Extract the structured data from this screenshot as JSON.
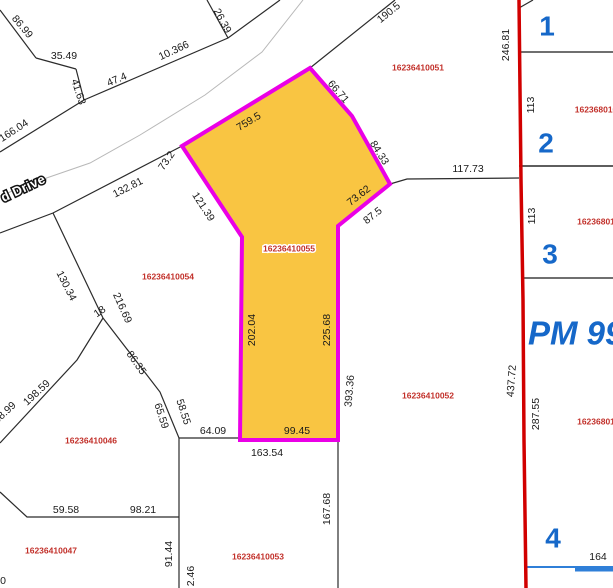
{
  "map": {
    "background": "#ffffff",
    "line_color": "#2b2b2b",
    "selected_parcel": {
      "id": "16236410055",
      "fill": "#f9c542",
      "stroke": "#ea00e6",
      "vertices": [
        [
          182,
          146
        ],
        [
          310,
          68
        ],
        [
          352,
          116
        ],
        [
          390,
          184
        ],
        [
          338,
          226
        ],
        [
          338,
          440
        ],
        [
          240,
          440
        ],
        [
          242,
          237
        ]
      ]
    },
    "pm_boundary": {
      "color": "#d10000",
      "points": [
        [
          519,
          0
        ],
        [
          520,
          90
        ],
        [
          521,
          180
        ],
        [
          523,
          300
        ],
        [
          524,
          440
        ],
        [
          526,
          588
        ]
      ]
    },
    "lines": [
      {
        "name": "lot-line",
        "points": [
          [
            0,
            10
          ],
          [
            36,
            58
          ]
        ]
      },
      {
        "name": "lot-line",
        "points": [
          [
            36,
            58
          ],
          [
            76,
            69
          ]
        ]
      },
      {
        "name": "lot-line",
        "points": [
          [
            76,
            69
          ],
          [
            84,
            100
          ]
        ]
      },
      {
        "name": "road-edge-upper",
        "points": [
          [
            84,
            100
          ],
          [
            228,
            38
          ],
          [
            280,
            0
          ]
        ]
      },
      {
        "name": "lot-line",
        "points": [
          [
            228,
            38
          ],
          [
            207,
            0
          ]
        ]
      },
      {
        "name": "road-edge-upper",
        "points": [
          [
            0,
            152
          ],
          [
            84,
            100
          ]
        ]
      },
      {
        "name": "road-centerline",
        "points": [
          [
            303,
            0
          ],
          [
            262,
            52
          ],
          [
            205,
            95
          ],
          [
            140,
            135
          ],
          [
            90,
            163
          ],
          [
            32,
            183
          ],
          [
            0,
            196
          ]
        ],
        "color": "#b8b8b8",
        "width": 1
      },
      {
        "name": "road-edge-lower",
        "points": [
          [
            395,
            0
          ],
          [
            310,
            68
          ]
        ]
      },
      {
        "name": "road-edge-lower",
        "points": [
          [
            182,
            146
          ],
          [
            53,
            213
          ],
          [
            0,
            233
          ]
        ]
      },
      {
        "name": "lot-line",
        "points": [
          [
            53,
            213
          ],
          [
            103,
            318
          ]
        ]
      },
      {
        "name": "lot-line",
        "points": [
          [
            103,
            318
          ],
          [
            160,
            392
          ],
          [
            179,
            438
          ]
        ]
      },
      {
        "name": "lot-line",
        "points": [
          [
            103,
            318
          ],
          [
            77,
            360
          ],
          [
            0,
            443
          ]
        ]
      },
      {
        "name": "lot-line",
        "points": [
          [
            179,
            438
          ],
          [
            338,
            438
          ]
        ]
      },
      {
        "name": "lot-line",
        "points": [
          [
            179,
            438
          ],
          [
            179,
            588
          ]
        ]
      },
      {
        "name": "lot-line",
        "points": [
          [
            338,
            440
          ],
          [
            338,
            588
          ]
        ]
      },
      {
        "name": "lot-line",
        "points": [
          [
            0,
            492
          ],
          [
            27,
            517
          ],
          [
            179,
            517
          ]
        ]
      },
      {
        "name": "lot-line",
        "points": [
          [
            390,
            184
          ],
          [
            407,
            179
          ],
          [
            519,
            178
          ]
        ]
      },
      {
        "name": "lot-line",
        "points": [
          [
            519,
            8
          ],
          [
            533,
            0
          ]
        ]
      },
      {
        "name": "section-line",
        "points": [
          [
            519,
            52
          ],
          [
            613,
            52
          ]
        ],
        "color": "#6f6f6f",
        "width": 2
      },
      {
        "name": "section-line",
        "points": [
          [
            519,
            166
          ],
          [
            613,
            166
          ]
        ],
        "color": "#5e5e5e",
        "width": 2
      },
      {
        "name": "section-line",
        "points": [
          [
            521,
            278
          ],
          [
            613,
            278
          ]
        ],
        "color": "#6f6f6f",
        "width": 2
      },
      {
        "name": "lot-line",
        "points": [
          [
            523,
            350
          ],
          [
            523,
            378
          ]
        ],
        "color": "#111111",
        "width": 1.5
      },
      {
        "name": "blue-line",
        "points": [
          [
            526,
            567
          ],
          [
            613,
            567
          ]
        ],
        "color": "#2f7fd8",
        "width": 2
      },
      {
        "name": "blue-line",
        "points": [
          [
            575,
            569
          ],
          [
            613,
            569
          ]
        ],
        "color": "#2f7fd8",
        "width": 5
      }
    ],
    "dimension_labels": [
      {
        "t": "86.99",
        "x": 22,
        "y": 27,
        "r": 50
      },
      {
        "t": "35.49",
        "x": 64,
        "y": 56,
        "r": 0
      },
      {
        "t": "41.63",
        "x": 78,
        "y": 92,
        "r": 72
      },
      {
        "t": "47.4",
        "x": 117,
        "y": 80,
        "r": -23
      },
      {
        "t": "10.366",
        "x": 174,
        "y": 51,
        "r": -25
      },
      {
        "t": "26.39",
        "x": 222,
        "y": 21,
        "r": 62
      },
      {
        "t": "190.5",
        "x": 389,
        "y": 13,
        "r": -39
      },
      {
        "t": "166.04",
        "x": 14,
        "y": 131,
        "r": -33
      },
      {
        "t": "132.81",
        "x": 128,
        "y": 188,
        "r": -27
      },
      {
        "t": "73.2",
        "x": 167,
        "y": 161,
        "r": -55
      },
      {
        "t": "759.5",
        "x": 249,
        "y": 122,
        "r": -31
      },
      {
        "t": "66.71",
        "x": 338,
        "y": 92,
        "r": 49
      },
      {
        "t": "84.33",
        "x": 379,
        "y": 153,
        "r": 58
      },
      {
        "t": "117.73",
        "x": 468,
        "y": 169,
        "r": 0
      },
      {
        "t": "73.62",
        "x": 359,
        "y": 196,
        "r": -38
      },
      {
        "t": "87.5",
        "x": 373,
        "y": 216,
        "r": -38
      },
      {
        "t": "121.39",
        "x": 203,
        "y": 207,
        "r": 57
      },
      {
        "t": "202.04",
        "x": 252,
        "y": 330,
        "r": -90
      },
      {
        "t": "225.68",
        "x": 327,
        "y": 330,
        "r": -90
      },
      {
        "t": "393.36",
        "x": 350,
        "y": 391,
        "r": -85
      },
      {
        "t": "99.45",
        "x": 297,
        "y": 431,
        "r": 0
      },
      {
        "t": "64.09",
        "x": 213,
        "y": 431,
        "r": 0
      },
      {
        "t": "163.54",
        "x": 267,
        "y": 453,
        "r": 0
      },
      {
        "t": "58.55",
        "x": 183,
        "y": 412,
        "r": 72
      },
      {
        "t": "65.59",
        "x": 161,
        "y": 416,
        "r": 72
      },
      {
        "t": "86.35",
        "x": 136,
        "y": 363,
        "r": 55
      },
      {
        "t": "216.69",
        "x": 122,
        "y": 308,
        "r": 66
      },
      {
        "t": "130.34",
        "x": 66,
        "y": 286,
        "r": 63
      },
      {
        "t": "18",
        "x": 100,
        "y": 312,
        "r": -35
      },
      {
        "t": "198.59",
        "x": 37,
        "y": 393,
        "r": -43
      },
      {
        "t": "68.99",
        "x": 5,
        "y": 413,
        "r": -43
      },
      {
        "t": "59.58",
        "x": 66,
        "y": 510,
        "r": 0
      },
      {
        "t": "98.21",
        "x": 143,
        "y": 510,
        "r": 0
      },
      {
        "t": "91.44",
        "x": 169,
        "y": 554,
        "r": -90
      },
      {
        "t": "2.46",
        "x": 191,
        "y": 576,
        "r": -90
      },
      {
        "t": "167.68",
        "x": 327,
        "y": 509,
        "r": -90
      },
      {
        "t": "246.81",
        "x": 506,
        "y": 45,
        "r": -90
      },
      {
        "t": "113",
        "x": 531,
        "y": 105,
        "r": -90
      },
      {
        "t": "113",
        "x": 532,
        "y": 216,
        "r": -90
      },
      {
        "t": "437.72",
        "x": 512,
        "y": 381,
        "r": -86
      },
      {
        "t": "287.55",
        "x": 536,
        "y": 414,
        "r": -90
      },
      {
        "t": "164",
        "x": 598,
        "y": 557,
        "r": 0
      },
      {
        "t": "0",
        "x": 3,
        "y": 581,
        "r": 0
      }
    ],
    "parcel_ids": [
      {
        "t": "16236410051",
        "x": 418,
        "y": 68
      },
      {
        "t": "16236410055",
        "x": 289,
        "y": 249,
        "halo": true
      },
      {
        "t": "16236410054",
        "x": 168,
        "y": 277
      },
      {
        "t": "16236410052",
        "x": 428,
        "y": 396
      },
      {
        "t": "16236410046",
        "x": 91,
        "y": 441
      },
      {
        "t": "16236410047",
        "x": 51,
        "y": 551
      },
      {
        "t": "16236410053",
        "x": 258,
        "y": 557
      },
      {
        "t": "162368010",
        "x": 596,
        "y": 110
      },
      {
        "t": "16236801",
        "x": 596,
        "y": 222
      },
      {
        "t": "16236801",
        "x": 596,
        "y": 422
      }
    ],
    "lot_numbers": [
      {
        "t": "1",
        "x": 547,
        "y": 28
      },
      {
        "t": "2",
        "x": 546,
        "y": 145
      },
      {
        "t": "3",
        "x": 550,
        "y": 256
      },
      {
        "t": "4",
        "x": 553,
        "y": 540
      }
    ],
    "pm_label": {
      "text": "PM 99",
      "x": 528,
      "y": 336
    },
    "road_label": {
      "text": "d Drive",
      "x": 2,
      "y": 199,
      "r": -25
    }
  }
}
